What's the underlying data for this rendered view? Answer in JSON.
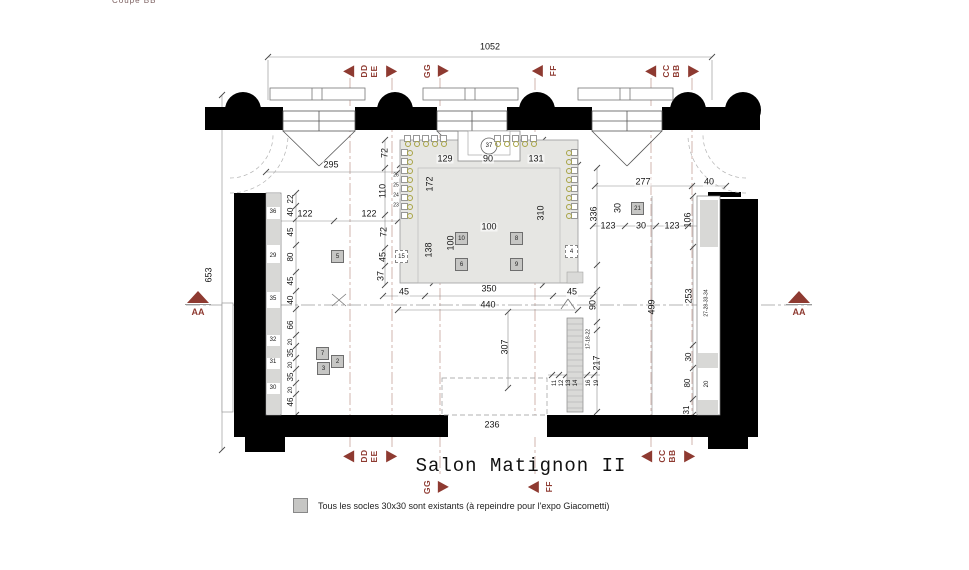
{
  "title": "Salon Matignon II",
  "corner_note": "Coupe BB",
  "legend": {
    "text": "Tous les socles 30x30 sont existants (à repeindre pour l'expo Giacometti)"
  },
  "colors": {
    "accent": "#8e3a31",
    "wall": "#000000",
    "carpet": "#e6e6e3",
    "socle": "#c6c6c4",
    "chair": "#a8a445",
    "dim": "#151515"
  },
  "section_markers": [
    {
      "labels": [
        "DD",
        "EE"
      ],
      "x": 370,
      "y": 71,
      "left": true,
      "right": true
    },
    {
      "labels": [
        "GG"
      ],
      "x": 436,
      "y": 71,
      "left": false,
      "right": true
    },
    {
      "labels": [
        "FF"
      ],
      "x": 545,
      "y": 71,
      "left": true,
      "right": false
    },
    {
      "labels": [
        "CC",
        "BB"
      ],
      "x": 672,
      "y": 71,
      "left": true,
      "right": true
    },
    {
      "labels": [
        "DD",
        "EE"
      ],
      "x": 370,
      "y": 456,
      "left": true,
      "right": true
    },
    {
      "labels": [
        "CC",
        "BB"
      ],
      "x": 668,
      "y": 456,
      "left": true,
      "right": true
    },
    {
      "labels": [
        "GG"
      ],
      "x": 436,
      "y": 487,
      "left": false,
      "right": true
    },
    {
      "labels": [
        "FF"
      ],
      "x": 541,
      "y": 487,
      "left": true,
      "right": false
    }
  ],
  "aa_markers": [
    {
      "label": "AA",
      "x": 198,
      "y": 291
    },
    {
      "label": "AA",
      "x": 799,
      "y": 291
    }
  ],
  "dims": [
    {
      "t": "1052",
      "x": 490,
      "y": 47
    },
    {
      "t": "295",
      "x": 331,
      "y": 165
    },
    {
      "t": "129",
      "x": 445,
      "y": 159
    },
    {
      "t": "90",
      "x": 488,
      "y": 159
    },
    {
      "t": "131",
      "x": 536,
      "y": 159
    },
    {
      "t": "277",
      "x": 643,
      "y": 182
    },
    {
      "t": "40",
      "x": 709,
      "y": 182
    },
    {
      "t": "122",
      "x": 305,
      "y": 214
    },
    {
      "t": "122",
      "x": 369,
      "y": 214
    },
    {
      "t": "123",
      "x": 608,
      "y": 226
    },
    {
      "t": "30",
      "x": 641,
      "y": 226
    },
    {
      "t": "123",
      "x": 672,
      "y": 226
    },
    {
      "t": "106",
      "x": 688,
      "y": 220,
      "r": 1
    },
    {
      "t": "336",
      "x": 594,
      "y": 214,
      "r": 1
    },
    {
      "t": "310",
      "x": 541,
      "y": 213,
      "r": 1
    },
    {
      "t": "172",
      "x": 430,
      "y": 184,
      "r": 1
    },
    {
      "t": "110",
      "x": 383,
      "y": 191,
      "r": 1
    },
    {
      "t": "72",
      "x": 385,
      "y": 153,
      "r": 1
    },
    {
      "t": "72",
      "x": 384,
      "y": 232,
      "r": 1
    },
    {
      "t": "45",
      "x": 383,
      "y": 257,
      "r": 1
    },
    {
      "t": "37",
      "x": 381,
      "y": 276,
      "r": 1
    },
    {
      "t": "138",
      "x": 429,
      "y": 250,
      "r": 1
    },
    {
      "t": "100",
      "x": 489,
      "y": 227
    },
    {
      "t": "100",
      "x": 451,
      "y": 243,
      "r": 1
    },
    {
      "t": "30",
      "x": 618,
      "y": 208,
      "r": 1
    },
    {
      "t": "22",
      "x": 291,
      "y": 199,
      "r": 1,
      "s": 8
    },
    {
      "t": "40",
      "x": 291,
      "y": 212,
      "r": 1,
      "s": 8
    },
    {
      "t": "45",
      "x": 291,
      "y": 232,
      "r": 1,
      "s": 8
    },
    {
      "t": "80",
      "x": 291,
      "y": 257,
      "r": 1,
      "s": 8
    },
    {
      "t": "45",
      "x": 291,
      "y": 281,
      "r": 1,
      "s": 8
    },
    {
      "t": "40",
      "x": 291,
      "y": 300,
      "r": 1,
      "s": 8
    },
    {
      "t": "66",
      "x": 291,
      "y": 325,
      "r": 1,
      "s": 8
    },
    {
      "t": "20",
      "x": 291,
      "y": 342,
      "r": 1,
      "s": 6
    },
    {
      "t": "35",
      "x": 291,
      "y": 353,
      "r": 1,
      "s": 8
    },
    {
      "t": "20",
      "x": 291,
      "y": 365,
      "r": 1,
      "s": 6
    },
    {
      "t": "35",
      "x": 291,
      "y": 377,
      "r": 1,
      "s": 8
    },
    {
      "t": "20",
      "x": 291,
      "y": 390,
      "r": 1,
      "s": 6
    },
    {
      "t": "46",
      "x": 291,
      "y": 402,
      "r": 1,
      "s": 8
    },
    {
      "t": "36",
      "x": 273,
      "y": 212,
      "s": 6
    },
    {
      "t": "29",
      "x": 273,
      "y": 256,
      "s": 6
    },
    {
      "t": "35",
      "x": 273,
      "y": 299,
      "s": 6
    },
    {
      "t": "32",
      "x": 273,
      "y": 340,
      "s": 6
    },
    {
      "t": "31",
      "x": 273,
      "y": 362,
      "s": 6
    },
    {
      "t": "30",
      "x": 273,
      "y": 388,
      "s": 6
    },
    {
      "t": "653",
      "x": 209,
      "y": 275,
      "r": 1
    },
    {
      "t": "45",
      "x": 404,
      "y": 292
    },
    {
      "t": "350",
      "x": 489,
      "y": 289
    },
    {
      "t": "45",
      "x": 572,
      "y": 292
    },
    {
      "t": "440",
      "x": 488,
      "y": 305
    },
    {
      "t": "90",
      "x": 593,
      "y": 305,
      "r": 1
    },
    {
      "t": "307",
      "x": 505,
      "y": 347,
      "r": 1
    },
    {
      "t": "236",
      "x": 492,
      "y": 425
    },
    {
      "t": "499",
      "x": 652,
      "y": 307,
      "r": 1
    },
    {
      "t": "253",
      "x": 689,
      "y": 296,
      "r": 1
    },
    {
      "t": "27-28-33-34",
      "x": 707,
      "y": 303,
      "r": 1,
      "s": 5
    },
    {
      "t": "30",
      "x": 689,
      "y": 357,
      "r": 1,
      "s": 8
    },
    {
      "t": "80",
      "x": 688,
      "y": 383,
      "r": 1,
      "s": 8
    },
    {
      "t": "31",
      "x": 687,
      "y": 410,
      "r": 1,
      "s": 8
    },
    {
      "t": "20",
      "x": 707,
      "y": 384,
      "r": 1,
      "s": 6
    },
    {
      "t": "217",
      "x": 597,
      "y": 363,
      "r": 1
    },
    {
      "t": "17-18-22",
      "x": 589,
      "y": 339,
      "r": 1,
      "s": 5
    },
    {
      "t": "11",
      "x": 555,
      "y": 383,
      "r": 1,
      "s": 6
    },
    {
      "t": "12",
      "x": 562,
      "y": 383,
      "r": 1,
      "s": 6
    },
    {
      "t": "13",
      "x": 569,
      "y": 383,
      "r": 1,
      "s": 6
    },
    {
      "t": "14",
      "x": 576,
      "y": 383,
      "r": 1,
      "s": 6
    },
    {
      "t": "16",
      "x": 589,
      "y": 383,
      "r": 1,
      "s": 6
    },
    {
      "t": "19",
      "x": 597,
      "y": 383,
      "r": 1,
      "s": 6
    },
    {
      "t": "26",
      "x": 396,
      "y": 176,
      "s": 5
    },
    {
      "t": "25",
      "x": 396,
      "y": 186,
      "s": 5
    },
    {
      "t": "24",
      "x": 396,
      "y": 196,
      "s": 5
    },
    {
      "t": "23",
      "x": 396,
      "y": 206,
      "s": 5
    },
    {
      "t": "37",
      "x": 489,
      "y": 146,
      "s": 6
    }
  ],
  "socles": [
    {
      "n": "10",
      "x": 455,
      "y": 232
    },
    {
      "n": "8",
      "x": 510,
      "y": 232
    },
    {
      "n": "6",
      "x": 455,
      "y": 258
    },
    {
      "n": "9",
      "x": 510,
      "y": 258
    },
    {
      "n": "5",
      "x": 331,
      "y": 250
    },
    {
      "n": "7",
      "x": 316,
      "y": 347
    },
    {
      "n": "2",
      "x": 331,
      "y": 355
    },
    {
      "n": "3",
      "x": 317,
      "y": 362
    },
    {
      "n": "21",
      "x": 631,
      "y": 202
    }
  ],
  "socles_dashed": [
    {
      "n": "15",
      "x": 395,
      "y": 250
    },
    {
      "n": "4",
      "x": 565,
      "y": 245
    }
  ],
  "chairs": [
    {
      "x": 404,
      "y": 135,
      "side": "b"
    },
    {
      "x": 413,
      "y": 135,
      "side": "b"
    },
    {
      "x": 422,
      "y": 135,
      "side": "b"
    },
    {
      "x": 431,
      "y": 135,
      "side": "b"
    },
    {
      "x": 440,
      "y": 135,
      "side": "b"
    },
    {
      "x": 494,
      "y": 135,
      "side": "b"
    },
    {
      "x": 503,
      "y": 135,
      "side": "b"
    },
    {
      "x": 512,
      "y": 135,
      "side": "b"
    },
    {
      "x": 521,
      "y": 135,
      "side": "b"
    },
    {
      "x": 530,
      "y": 135,
      "side": "b"
    },
    {
      "x": 401,
      "y": 149,
      "side": "r"
    },
    {
      "x": 401,
      "y": 158,
      "side": "r"
    },
    {
      "x": 401,
      "y": 167,
      "side": "r"
    },
    {
      "x": 401,
      "y": 176,
      "side": "r"
    },
    {
      "x": 401,
      "y": 185,
      "side": "r"
    },
    {
      "x": 401,
      "y": 194,
      "side": "r"
    },
    {
      "x": 401,
      "y": 203,
      "side": "r"
    },
    {
      "x": 401,
      "y": 212,
      "side": "r"
    },
    {
      "x": 571,
      "y": 149,
      "side": "l"
    },
    {
      "x": 571,
      "y": 158,
      "side": "l"
    },
    {
      "x": 571,
      "y": 167,
      "side": "l"
    },
    {
      "x": 571,
      "y": 176,
      "side": "l"
    },
    {
      "x": 571,
      "y": 185,
      "side": "l"
    },
    {
      "x": 571,
      "y": 194,
      "side": "l"
    },
    {
      "x": 571,
      "y": 203,
      "side": "l"
    },
    {
      "x": 571,
      "y": 212,
      "side": "l"
    }
  ]
}
